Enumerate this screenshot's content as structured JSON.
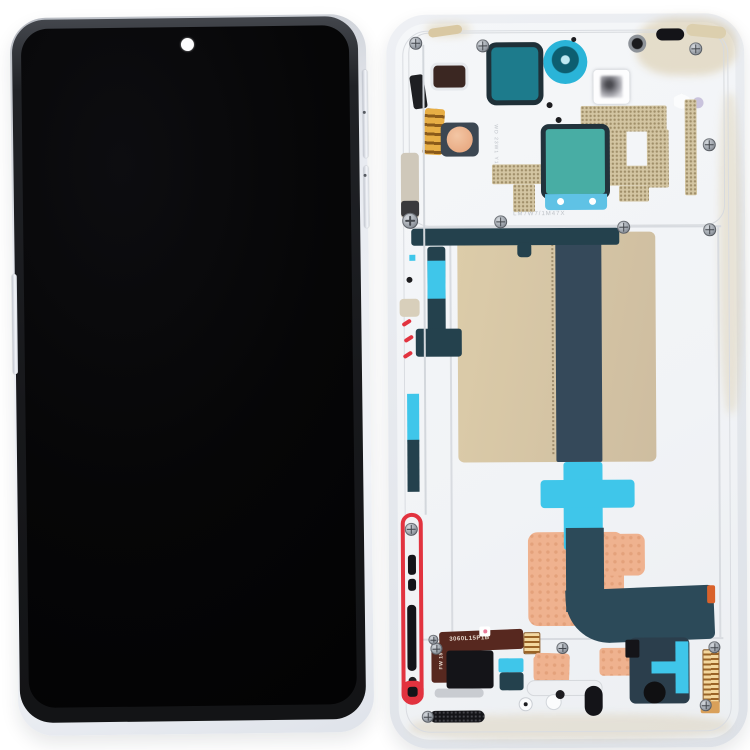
{
  "meta": {
    "title": "LCD screen digitizer full assembly with frame - front and rear product photo",
    "background": "#ffffff"
  },
  "palette": {
    "bg": "#ffffff",
    "punch": "#fcfcfd",
    "navy": "#24414d",
    "cyan": "#3fc6ea",
    "tealDark": "#1d7b8c",
    "camRing": "#38bfe0",
    "patchTeal": "#48ada4",
    "patchBlue": "#5fc2e5",
    "tan": "#d7c7a4",
    "speckle": "#d3c5a2",
    "flexDark": "#35495a",
    "salmon": "#efb28f",
    "gold": "#e3a93f",
    "maroon": "#57281f",
    "red": "#e2333f",
    "blackpart": "#141418"
  },
  "front_view": {
    "name": "front display assembly",
    "features": [
      "black display panel",
      "punch-hole front camera dot",
      "silver metal frame",
      "volume rocker",
      "power button",
      "left side key"
    ]
  },
  "back_view": {
    "name": "rear mid-frame assembly",
    "labels": {
      "flex_label": "3060L15P1B",
      "flex_label_vertical": "FW 1814",
      "etched_label": "LM7W7/1M47X",
      "etched_label_vertical": "WD 23W1 Y1"
    },
    "components": [
      "earpiece adhesive patch",
      "front camera ring",
      "proximity sensor window",
      "antenna gold contacts",
      "copper coil pad",
      "qr-code sticker",
      "speckled adhesive strips",
      "center teal heat patch",
      "graphite film sheet",
      "main flex cable",
      "cyan adhesive cross",
      "copper heat spreader",
      "side-key red gasket",
      "sim reader flex",
      "bottom speaker mesh",
      "fpc gold connector",
      "corner screws"
    ]
  }
}
